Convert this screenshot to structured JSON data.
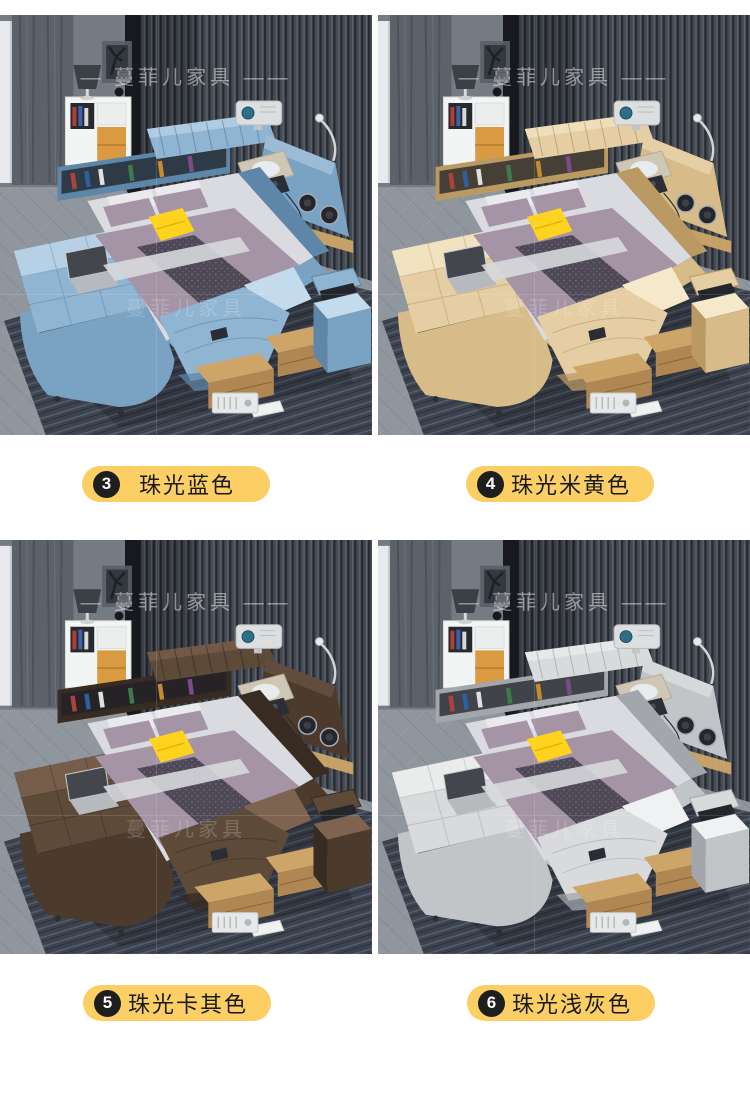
{
  "watermark": {
    "brand": "蔓菲儿家具",
    "line": "— 蔓菲儿家具 ——"
  },
  "label_style": {
    "pill_bg": "#FBCF63",
    "badge_bg": "#1E1E1E",
    "badge_fg": "#FFFFFF",
    "text_color": "#1A1A1A"
  },
  "scene": {
    "wall": "#464B53",
    "wall_rib_dark": "#262A31",
    "wall_rib_light": "#5D636C",
    "left_wall": "#757B83",
    "curtain": "#5C6269",
    "sheer": "#CCD0D5",
    "floor": "#90969D",
    "rug": "#3C434F",
    "rug_stripe": "#59616E",
    "wood": "#CDA568",
    "wood_front": "#B08752",
    "bedding_mauve": "#A494A6",
    "bedding_runner": "#4D4756",
    "bedding_sheet": "#DADBE0",
    "accent_pillow_yellow": "#FDD31D",
    "cabinet_drawer_yellow": "#D99A41"
  },
  "variants": [
    {
      "badge": "3",
      "name": "珠光蓝色",
      "bed_color": "#8FB5D3",
      "palette": {
        "base": "#8FB5D3",
        "light": "#C3DBEC",
        "mid": "#7AA2C2",
        "shadow": "#5E86A8",
        "dark": "#42617F"
      }
    },
    {
      "badge": "4",
      "name": "珠光米黄色",
      "bed_color": "#E5CEA3",
      "palette": {
        "base": "#E5CEA3",
        "light": "#F6E9C9",
        "mid": "#D7BB88",
        "shadow": "#BA9963",
        "dark": "#8F7343"
      }
    },
    {
      "badge": "5",
      "name": "珠光卡其色",
      "bed_color": "#5E4A39",
      "palette": {
        "base": "#5E4A39",
        "light": "#7E6450",
        "mid": "#4C3B2D",
        "shadow": "#382B21",
        "dark": "#201813"
      }
    },
    {
      "badge": "6",
      "name": "珠光浅灰色",
      "bed_color": "#D8DADC",
      "palette": {
        "base": "#D8DADC",
        "light": "#F0F1F2",
        "mid": "#C2C5C8",
        "shadow": "#A3A7AB",
        "dark": "#7F8488"
      }
    }
  ]
}
